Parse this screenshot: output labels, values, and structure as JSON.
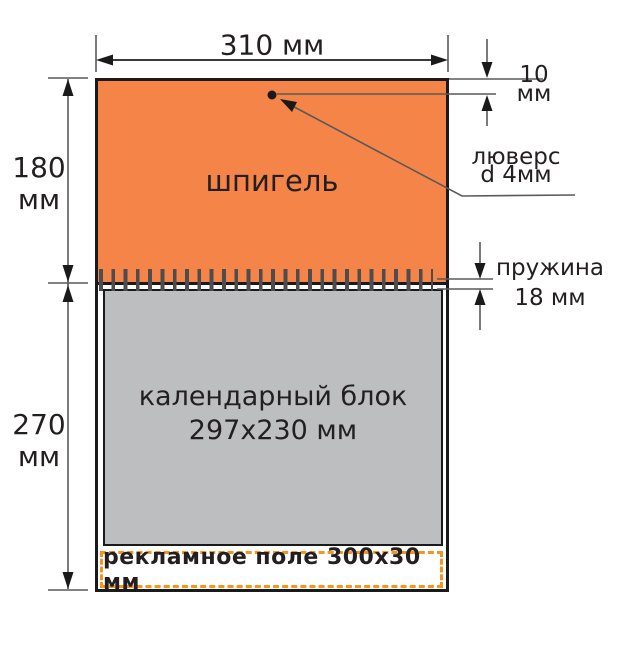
{
  "canvas": {
    "width": 619,
    "height": 646,
    "background": "#ffffff"
  },
  "colors": {
    "header_orange": "#f48447",
    "calendar_gray": "#bcbec0",
    "ad_dash_orange": "#f7941d",
    "ink": "#231f20",
    "dimension_line": "#58595b",
    "spring_tick": "#4d4d4f"
  },
  "diagram": {
    "header_label": "шпигель",
    "calendar_block": {
      "line1": "календарный блок",
      "line2": "297x230 мм"
    },
    "ad_field_label": "рекламное поле 300x30 мм"
  },
  "dimensions": {
    "total_width": {
      "text": "310 мм"
    },
    "header_height": {
      "line1": "180",
      "line2": "мм"
    },
    "block_height": {
      "line1": "270",
      "line2": "мм"
    },
    "eyelet_offset": {
      "line1": "10",
      "line2": "мм"
    },
    "eyelet": {
      "line1": "люверс",
      "line2": "d 4мм"
    },
    "spring": {
      "line1": "пружина",
      "line2": "18 мм"
    }
  }
}
